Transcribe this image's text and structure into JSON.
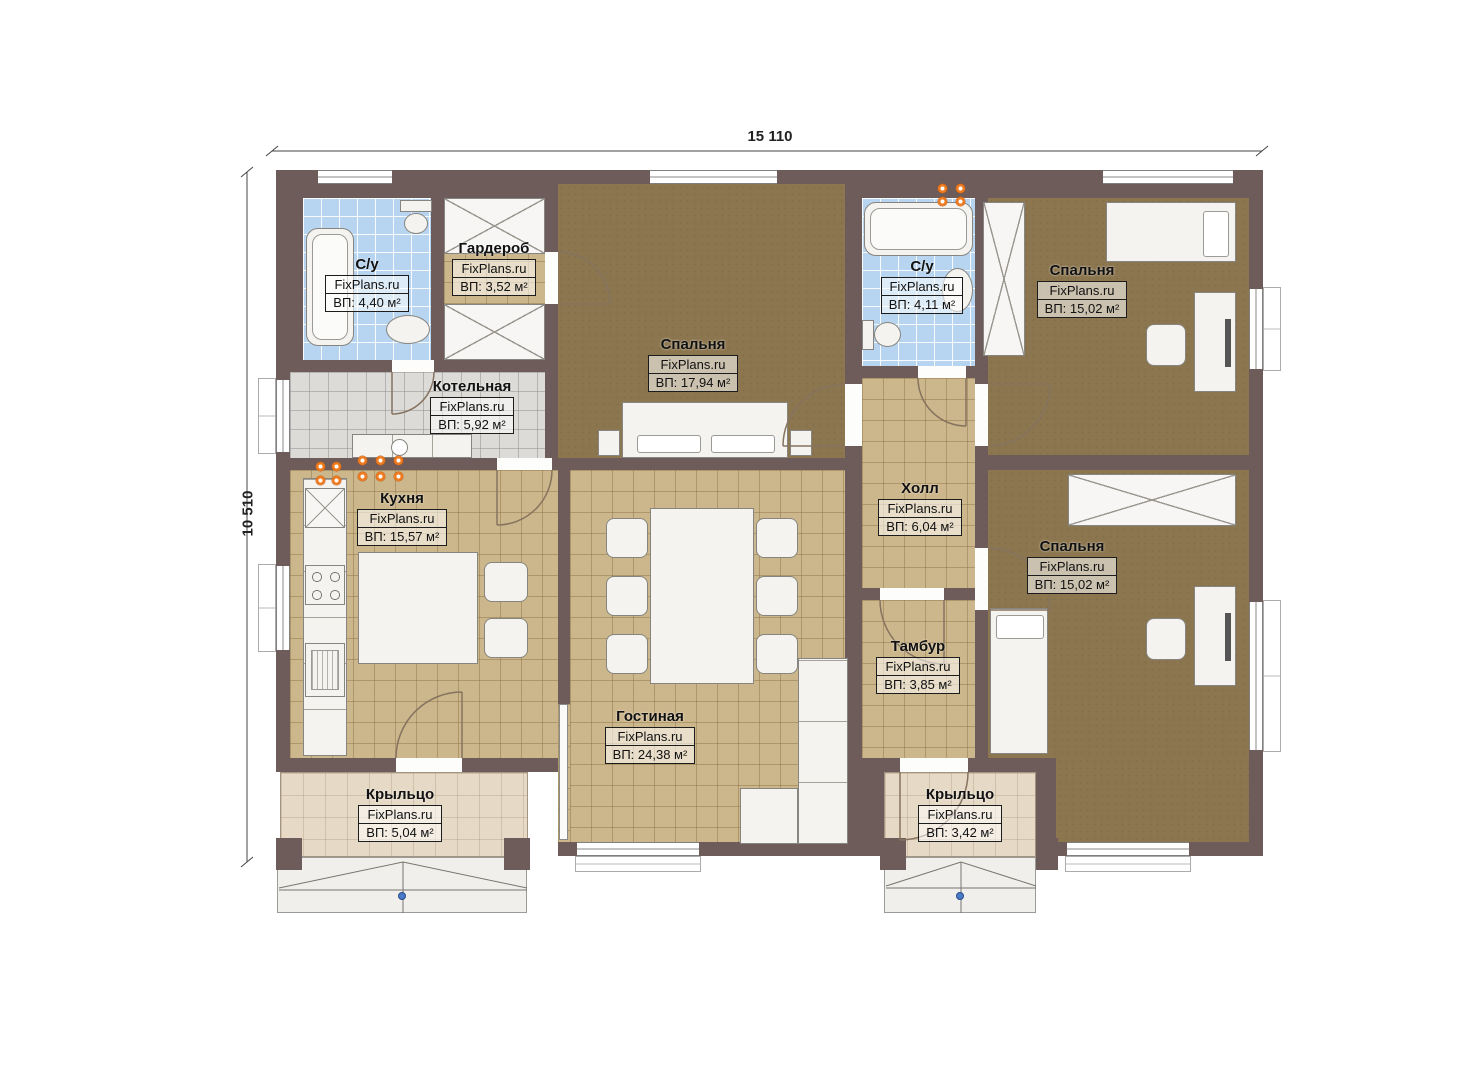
{
  "site_brand": "FixPlans.ru",
  "dimensions": {
    "width_label": "15 110",
    "height_label": "10 510"
  },
  "rooms": [
    {
      "key": "bathroom-1",
      "name": "С/у",
      "brand": "FixPlans.ru",
      "area": "ВП: 4,40 м²"
    },
    {
      "key": "wardrobe",
      "name": "Гардероб",
      "brand": "FixPlans.ru",
      "area": "ВП: 3,52 м²"
    },
    {
      "key": "bedroom-center",
      "name": "Спальня",
      "brand": "FixPlans.ru",
      "area": "ВП: 17,94 м²"
    },
    {
      "key": "bathroom-2",
      "name": "С/у",
      "brand": "FixPlans.ru",
      "area": "ВП: 4,11 м²"
    },
    {
      "key": "bedroom-top-right",
      "name": "Спальня",
      "brand": "FixPlans.ru",
      "area": "ВП: 15,02 м²"
    },
    {
      "key": "boiler-room",
      "name": "Котельная",
      "brand": "FixPlans.ru",
      "area": "ВП: 5,92 м²"
    },
    {
      "key": "kitchen",
      "name": "Кухня",
      "brand": "FixPlans.ru",
      "area": "ВП: 15,57 м²"
    },
    {
      "key": "hall",
      "name": "Холл",
      "brand": "FixPlans.ru",
      "area": "ВП: 6,04 м²"
    },
    {
      "key": "bedroom-bottom-right",
      "name": "Спальня",
      "brand": "FixPlans.ru",
      "area": "ВП: 15,02 м²"
    },
    {
      "key": "vestibule",
      "name": "Тамбур",
      "brand": "FixPlans.ru",
      "area": "ВП: 3,85 м²"
    },
    {
      "key": "living-room",
      "name": "Гостиная",
      "brand": "FixPlans.ru",
      "area": "ВП: 24,38 м²"
    },
    {
      "key": "porch-left",
      "name": "Крыльцо",
      "brand": "FixPlans.ru",
      "area": "ВП: 5,04 м²"
    },
    {
      "key": "porch-right",
      "name": "Крыльцо",
      "brand": "FixPlans.ru",
      "area": "ВП: 3,42 м²"
    }
  ],
  "colors": {
    "wall": "#6e5c5b",
    "floor_bedroom": "#8c764f",
    "floor_tile_tan": "#ccb68b",
    "floor_tile_blue": "#b7d4f0",
    "floor_tile_gray": "#dcdbd8",
    "porch_floor": "#e6dac6",
    "marker_orange": "#f07a1e",
    "marker_blue": "#4a7ac8"
  }
}
